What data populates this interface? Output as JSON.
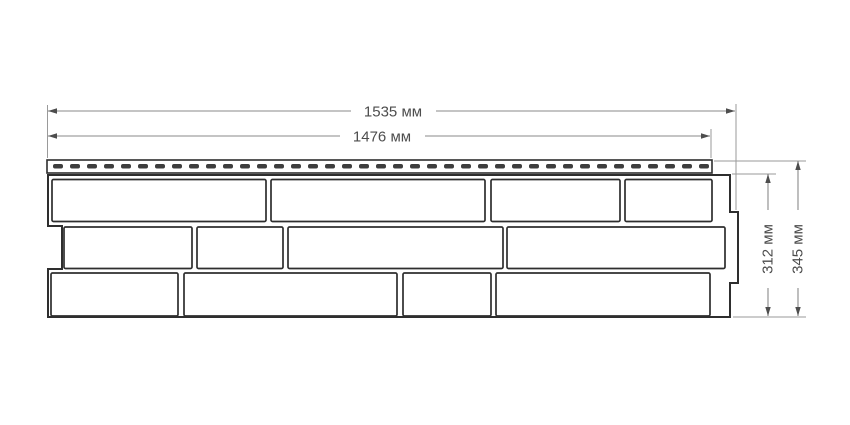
{
  "colors": {
    "background": "#ffffff",
    "object_line": "#2e2e2e",
    "dimension_line": "#8a8a8a",
    "text": "#4d4d4d",
    "slot_fill": "#3d3d3d"
  },
  "dimensions": {
    "top_outer": "1535 мм",
    "top_inner": "1476 мм",
    "right_inner": "312 мм",
    "right_outer": "345 мм"
  },
  "panel": {
    "outline_path": "M 48,175 H 730 V 212 H 738 V 283 H 730 V 317 H 48 V 269 H 62 V 226 H 48 Z",
    "nail_strip": {
      "x": 47,
      "y": 160,
      "width": 665,
      "height": 13,
      "slot": {
        "start_x": 53,
        "y": 164,
        "width": 10,
        "height": 4.5,
        "pitch": 17,
        "count": 39
      }
    },
    "brick_rows": [
      {
        "y": 179.5,
        "height": 42,
        "bricks": [
          [
            52,
            214
          ],
          [
            271,
            214
          ],
          [
            491,
            129
          ],
          [
            625,
            87
          ]
        ]
      },
      {
        "y": 227,
        "height": 41.5,
        "bricks": [
          [
            64,
            128
          ],
          [
            197,
            86
          ],
          [
            288,
            215
          ],
          [
            507,
            218
          ]
        ]
      },
      {
        "y": 273,
        "height": 43,
        "bricks": [
          [
            51,
            127
          ],
          [
            184,
            213
          ],
          [
            403,
            88
          ],
          [
            496,
            214
          ]
        ]
      }
    ]
  }
}
